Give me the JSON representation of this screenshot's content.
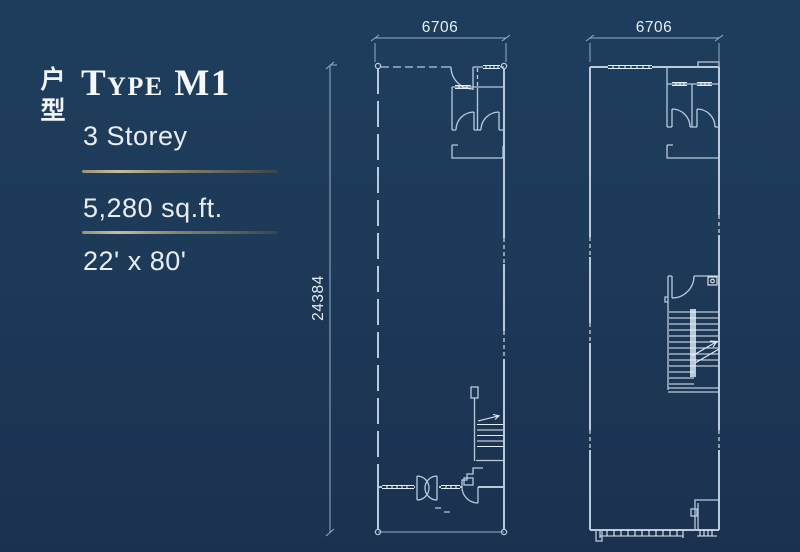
{
  "page": {
    "background_color_top": "#1e3d5d",
    "background_color_bottom": "#1b3150",
    "line_color": "#b9cadc",
    "bright_line_color": "#e8eef5",
    "dimension_line_color": "#98adc4",
    "divider_gold_light": "#c6bda3",
    "divider_gold_dark": "#3c4349"
  },
  "panel": {
    "cjk_vertical_label": "户型",
    "title": "Type M1",
    "storey": "3 Storey",
    "area": "5,280 sq.ft.",
    "size": "22' x 80'"
  },
  "plans": {
    "ground": {
      "width_label": "6706",
      "depth_label": "24384"
    },
    "upper": {
      "width_label": "6706"
    }
  }
}
